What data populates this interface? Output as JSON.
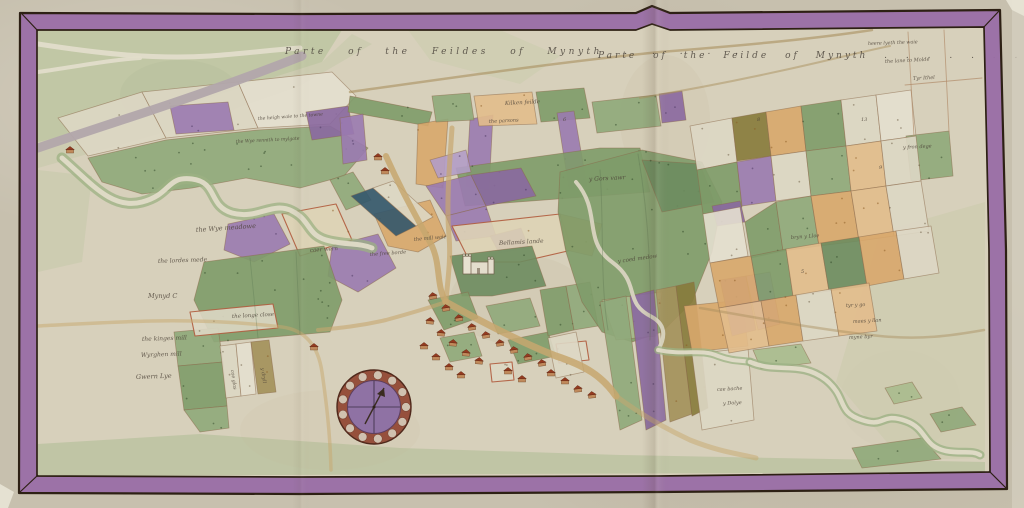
{
  "title": {
    "left": "Parte of the Feildes of Mynyth . . . . .",
    "right": "Parte of the Feilde of Mynyth . . . . . . ."
  },
  "palette": {
    "outer_parchment": "#c7c0ae",
    "map_bg": "#d7d0bb",
    "border_purple": "#9a6ea6",
    "border_outline": "#2d2014",
    "g1": "#7e9b69",
    "g2": "#8fa97a",
    "g3": "#a9bb8e",
    "g4": "#6d8c5f",
    "o1": "#d8a76c",
    "o2": "#e2bd8c",
    "o3": "#c98f52",
    "p1": "#9a7ab0",
    "p2": "#8a68a0",
    "p3": "#b39cc6",
    "w1": "#ddd7c4",
    "w2": "#e4dfcf",
    "olv": "#877a3b",
    "olv2": "#a3905a",
    "blu": "#33566c",
    "cream": "#ded3b6",
    "road": "#c7a76e",
    "hedge": "#a98f5e",
    "river_bank": "#9cb183",
    "river_water": "#e0dbc8",
    "grey_way": "#b2a7ab",
    "house_wall": "#c08a5c",
    "house_roof": "#943b20",
    "compass_ring": "#96503c",
    "compass_face": "#8f72a4",
    "default_stroke": "#8a6a4a",
    "red_stroke": "#b05b3d",
    "label_ink": "#4a4036"
  },
  "border": {
    "outer": "20,13 300,14 636,13 652,6 670,13 1000,10 1006,250 1007,489 660,492 300,494 19,493",
    "inner": "37,30 636,30 652,24 670,30 984,27 989,250 990,472 660,476 300,477 37,476"
  },
  "washes": [
    {
      "pts": "38,30 342,30 322,62 202,100 122,122 38,142",
      "fill": "#aebf93",
      "op": 0.55
    },
    {
      "pts": "38,142 122,122 202,100 322,62 352,34 372,44 300,86 180,128 38,168",
      "fill": "#b7c49c",
      "op": 0.3
    },
    {
      "pts": "880,232 985,202 985,458 902,460 836,382",
      "fill": "#c5c9a5",
      "op": 0.4
    },
    {
      "pts": "38,444 200,434 400,448 620,455 985,462 985,472 38,476",
      "fill": "#a9ba90",
      "op": 0.5
    },
    {
      "pts": "38,170 92,176 82,262 38,272",
      "fill": "#b7c49c",
      "op": 0.3
    },
    {
      "pts": "408,30 500,30 560,56 520,84 430,60",
      "fill": "#c2cba6",
      "op": 0.35
    }
  ],
  "stains": [
    {
      "cx": 520,
      "cy": 300,
      "rx": 70,
      "ry": 45,
      "fill": "#b5a584",
      "op": 0.1
    },
    {
      "cx": 665,
      "cy": 120,
      "rx": 45,
      "ry": 65,
      "fill": "#b5a584",
      "op": 0.08
    },
    {
      "cx": 180,
      "cy": 95,
      "rx": 60,
      "ry": 35,
      "fill": "#9fae84",
      "op": 0.12
    },
    {
      "cx": 330,
      "cy": 430,
      "rx": 90,
      "ry": 40,
      "fill": "#c3b694",
      "op": 0.1
    },
    {
      "cx": 900,
      "cy": 400,
      "rx": 60,
      "ry": 50,
      "fill": "#cfc8ae",
      "op": 0.12
    }
  ],
  "parcels": [
    {
      "pts": "58,118 142,92 166,138 88,156",
      "fill": "w1"
    },
    {
      "pts": "142,92 238,82 258,128 166,138",
      "fill": "w1"
    },
    {
      "pts": "238,82 332,72 356,96 330,124 258,128",
      "fill": "w2"
    },
    {
      "pts": "88,158 166,140 258,130 330,126 368,148 344,176 300,188 246,178 192,188 142,194 102,182",
      "fill": "g2"
    },
    {
      "pts": "170,106 228,102 234,130 176,134",
      "fill": "p1"
    },
    {
      "pts": "306,112 348,106 354,134 312,140",
      "fill": "p2"
    },
    {
      "pts": "228,224 274,214 290,244 254,262 224,250",
      "fill": "p1"
    },
    {
      "pts": "282,214 336,204 352,240 300,256",
      "fill": "cream",
      "stroke": "red"
    },
    {
      "pts": "332,246 378,234 396,268 358,292 328,276",
      "fill": "p1"
    },
    {
      "pts": "374,214 430,200 446,236 418,252 388,246",
      "fill": "o1"
    },
    {
      "pts": "204,262 324,246 342,300 330,332 214,342 194,300",
      "fill": "g1"
    },
    {
      "pts": "174,332 218,328 223,362 178,366",
      "fill": "g2"
    },
    {
      "pts": "178,366 223,362 227,406 184,410",
      "fill": "g1"
    },
    {
      "pts": "184,410 227,406 229,428 200,432",
      "fill": "g2"
    },
    {
      "pts": "190,312 273,304 278,328 195,336",
      "fill": "w1",
      "stroke": "red"
    },
    {
      "pts": "220,346 236,344 241,396 226,398",
      "fill": "w1"
    },
    {
      "pts": "236,344 251,342 256,394 241,396",
      "fill": "w2"
    },
    {
      "pts": "251,342 269,340 276,392 258,394",
      "fill": "olv2"
    },
    {
      "pts": "350,96 432,112 428,126 348,112",
      "fill": "g1"
    },
    {
      "pts": "340,118 363,114 367,160 343,164",
      "fill": "p1"
    },
    {
      "pts": "418,124 448,119 443,188 416,184",
      "fill": "o1"
    },
    {
      "pts": "470,119 493,115 489,190 466,187",
      "fill": "p1"
    },
    {
      "pts": "432,96 470,93 474,120 436,122",
      "fill": "g2"
    },
    {
      "pts": "474,96 532,92 537,124 479,126",
      "fill": "o2"
    },
    {
      "pts": "536,92 584,88 590,118 541,122",
      "fill": "g1"
    },
    {
      "pts": "557,113 574,111 587,186 569,189",
      "fill": "p1"
    },
    {
      "pts": "592,102 656,95 661,126 597,133",
      "fill": "g2"
    },
    {
      "pts": "659,94 682,91 686,120 662,123",
      "fill": "p2"
    },
    {
      "pts": "456,168 600,148 640,148 650,192 465,206",
      "fill": "g1"
    },
    {
      "pts": "330,180 353,172 371,200 346,210",
      "fill": "g2"
    },
    {
      "pts": "351,196 373,188 416,226 396,236",
      "fill": "blu"
    },
    {
      "pts": "373,188 393,181 433,217 416,226",
      "fill": "w1"
    },
    {
      "pts": "426,186 471,175 486,206 446,216",
      "fill": "p1"
    },
    {
      "pts": "471,175 521,168 536,196 486,206",
      "fill": "p2"
    },
    {
      "pts": "446,216 486,206 496,236 456,241",
      "fill": "p1"
    },
    {
      "pts": "490,236 521,228 529,248 499,253",
      "fill": "p2"
    },
    {
      "pts": "430,160 466,150 471,172 438,178",
      "fill": "p3"
    },
    {
      "pts": "452,226 560,214 572,250 520,262 470,262",
      "fill": "cream",
      "stroke": "red"
    },
    {
      "pts": "560,214 602,224 592,256 566,250",
      "fill": "o1"
    },
    {
      "pts": "450,256 532,246 546,286 492,296 462,296",
      "fill": "g4"
    },
    {
      "pts": "428,300 468,292 478,318 444,330",
      "fill": "g1"
    },
    {
      "pts": "486,306 530,298 540,326 498,334",
      "fill": "g2"
    },
    {
      "pts": "508,340 548,332 556,356 518,364",
      "fill": "g1"
    },
    {
      "pts": "440,338 474,332 482,356 450,362",
      "fill": "g2"
    },
    {
      "pts": "490,364 512,362 514,380 492,382",
      "fill": "w1",
      "stroke": "red"
    },
    {
      "pts": "556,344 586,341 589,360 559,363",
      "fill": "w1",
      "stroke": "red"
    },
    {
      "pts": "540,290 566,286 574,330 548,336",
      "fill": "g1"
    },
    {
      "pts": "566,286 590,282 598,326 574,330",
      "fill": "g2"
    },
    {
      "pts": "548,338 576,332 584,372 556,378",
      "fill": "w1"
    },
    {
      "pts": "560,172 642,150 702,162 722,202 712,252 692,302 662,332 632,342 602,332 582,302 566,252 558,212",
      "fill": "g1"
    },
    {
      "pts": "642,160 700,164 714,202 662,212",
      "fill": "g4"
    },
    {
      "pts": "602,300 662,292 656,336 616,340",
      "fill": "g3"
    },
    {
      "pts": "600,302 626,296 642,420 620,430",
      "fill": "g2"
    },
    {
      "pts": "630,296 654,290 666,420 646,430",
      "fill": "p2"
    },
    {
      "pts": "656,290 676,286 692,414 670,422",
      "fill": "olv2"
    },
    {
      "pts": "676,286 694,282 708,408 692,416",
      "fill": "olv"
    },
    {
      "pts": "684,306 742,300 748,346 692,352",
      "fill": "o1"
    },
    {
      "pts": "692,354 748,348 754,420 702,430",
      "fill": "w1"
    },
    {
      "pts": "720,280 746,276 756,330 732,336",
      "fill": "p1"
    },
    {
      "pts": "746,276 770,272 780,324 758,330",
      "fill": "p3"
    },
    {
      "pts": "690,126 732,118 737,162 697,170",
      "fill": "w1"
    },
    {
      "pts": "732,118 766,112 771,156 737,161",
      "fill": "olv"
    },
    {
      "pts": "766,112 801,106 806,151 771,156",
      "fill": "o1"
    },
    {
      "pts": "801,106 841,100 846,146 806,151",
      "fill": "g1"
    },
    {
      "pts": "841,100 876,95 881,141 846,146",
      "fill": "w1"
    },
    {
      "pts": "876,95 911,90 916,136 881,141",
      "fill": "w2"
    },
    {
      "pts": "906,136 949,131 953,176 911,181",
      "fill": "g2"
    },
    {
      "pts": "697,170 737,162 742,207 703,214",
      "fill": "g1"
    },
    {
      "pts": "737,162 771,156 776,201 742,206",
      "fill": "p1"
    },
    {
      "pts": "771,156 806,151 811,196 776,201",
      "fill": "w1"
    },
    {
      "pts": "806,151 846,146 851,191 811,196",
      "fill": "g2"
    },
    {
      "pts": "846,146 881,141 886,186 851,191",
      "fill": "o2"
    },
    {
      "pts": "881,141 916,136 921,181 886,186",
      "fill": "w1"
    },
    {
      "pts": "712,206 740,201 745,222 717,226",
      "fill": "p2"
    },
    {
      "pts": "703,214 740,207 748,256 710,263",
      "fill": "w2"
    },
    {
      "pts": "745,222 776,202 783,251 751,258",
      "fill": "g1"
    },
    {
      "pts": "776,202 811,196 819,246 783,251",
      "fill": "g2"
    },
    {
      "pts": "811,196 851,191 859,241 819,246",
      "fill": "o1"
    },
    {
      "pts": "851,191 886,186 894,236 859,241",
      "fill": "o2"
    },
    {
      "pts": "886,186 921,181 929,231 894,236",
      "fill": "w1"
    },
    {
      "pts": "710,263 751,256 759,301 719,308",
      "fill": "o1"
    },
    {
      "pts": "751,256 786,249 793,296 759,301",
      "fill": "g1"
    },
    {
      "pts": "786,249 821,243 829,291 793,296",
      "fill": "o2"
    },
    {
      "pts": "821,243 859,237 867,286 829,291",
      "fill": "g4"
    },
    {
      "pts": "859,237 896,231 904,279 867,286",
      "fill": "o1"
    },
    {
      "pts": "896,231 931,226 939,273 904,279",
      "fill": "w1"
    },
    {
      "pts": "719,308 761,301 769,346 729,353",
      "fill": "o2"
    },
    {
      "pts": "761,301 796,295 803,341 769,346",
      "fill": "o1"
    },
    {
      "pts": "796,295 831,289 839,336 803,341",
      "fill": "w1"
    },
    {
      "pts": "831,289 869,283 877,331 839,336",
      "fill": "o2"
    },
    {
      "pts": "753,350 801,344 811,363 761,369",
      "fill": "g3"
    },
    {
      "pts": "852,448 922,438 941,459 862,468",
      "fill": "g2"
    },
    {
      "pts": "930,414 962,407 976,425 941,432",
      "fill": "g2"
    },
    {
      "pts": "885,388 912,382 922,398 894,404",
      "fill": "g3"
    }
  ],
  "rivers": [
    {
      "d": "M38,148 C120,120 200,96 302,56",
      "bw": 0,
      "bc": "none",
      "ww": 9,
      "wc": "#b2a7ab"
    },
    {
      "d": "M38,44 C90,52 150,60 210,56 C250,53 270,50 300,48",
      "bw": 0,
      "bc": "none",
      "ww": 5,
      "wc": "#e2ddca"
    },
    {
      "d": "M38,72 C80,66 110,60 140,58",
      "bw": 0,
      "bc": "none",
      "ww": 4,
      "wc": "#e2ddca"
    },
    {
      "d": "M62,158 C92,184 112,210 142,202 C172,194 166,176 192,179 C218,182 208,206 232,213 C258,220 272,201 292,211 C312,221 306,236 330,241 C348,245 360,243 372,248",
      "bw": 11,
      "bc": "#9cb183",
      "ww": 5,
      "wc": "#e0dbc8"
    },
    {
      "d": "M576,182 C602,212 582,240 612,262 C642,284 622,302 652,317 C668,326 664,340 658,350",
      "bw": 0,
      "bc": "none",
      "ww": 4,
      "wc": "#d9d4c0"
    },
    {
      "d": "M658,350 C686,356 700,348 718,356 C734,362 742,360 750,362",
      "bw": 8,
      "bc": "#9cb183",
      "ww": 4,
      "wc": "#e0dbc8"
    },
    {
      "d": "M750,362 C778,374 800,360 826,380 C848,398 836,412 862,420 C886,428 880,412 906,421 C928,429 922,446 946,451 C962,454 972,450 980,455",
      "bw": 9,
      "bc": "#9bb083",
      "ww": 4.5,
      "wc": "#e0dbc8"
    }
  ],
  "roads": [
    {
      "d": "M386,156 C402,192 416,216 432,246 C441,266 436,286 446,302",
      "w": 6,
      "c": "#c7a76e",
      "o": 0.85
    },
    {
      "d": "M446,302 C482,322 520,342 556,356 C586,366 602,376 616,396",
      "w": 7,
      "c": "#c7a76e",
      "o": 0.85
    },
    {
      "d": "M452,128 C450,160 446,200 449,236 C451,258 448,278 446,300",
      "w": 5,
      "c": "#c7a76e",
      "o": 0.7
    },
    {
      "d": "M616,396 C640,414 664,428 690,440 C720,452 740,454 756,458",
      "w": 5,
      "c": "#c7a76e",
      "o": 0.5
    },
    {
      "d": "M446,302 C428,308 408,314 386,320 C360,326 340,328 318,330",
      "w": 4,
      "c": "#c7a76e",
      "o": 0.6
    },
    {
      "d": "M38,326 C120,322 190,316 282,327 C305,330 318,345 322,372 C326,400 330,430 331,470",
      "w": 3.5,
      "c": "#c7a76e",
      "o": 0.5
    },
    {
      "d": "M350,92 C450,78 560,62 660,52 C760,44 820,38 872,30",
      "w": 2.5,
      "c": "#a98f5e",
      "o": 0.6
    },
    {
      "d": "M640,98 C700,88 760,76 820,62 C850,55 870,50 890,46",
      "w": 2,
      "c": "#a98f5e",
      "o": 0.5
    },
    {
      "d": "M700,308 C760,318 820,330 880,336 C920,340 950,336 984,330",
      "w": 2.5,
      "c": "#a98f5e",
      "o": 0.45
    },
    {
      "d": "M908,32 L914,136",
      "w": 0.9,
      "c": "#b08a68",
      "o": 0.7
    },
    {
      "d": "M944,30 L949,132",
      "w": 0.9,
      "c": "#b08a68",
      "o": 0.7
    },
    {
      "d": "M905,85 L982,78",
      "w": 0.9,
      "c": "#b08a68",
      "o": 0.7
    },
    {
      "d": "M600,170 C604,224 600,282 608,330",
      "w": 1,
      "c": "#5c7350",
      "o": 0.35
    },
    {
      "d": "M638,154 C648,212 652,272 650,340",
      "w": 1,
      "c": "#5c7350",
      "o": 0.35
    },
    {
      "d": "M250,258 L258,338",
      "w": 0.9,
      "c": "#54704c",
      "o": 0.3
    },
    {
      "d": "M296,252 L300,334",
      "w": 0.9,
      "c": "#54704c",
      "o": 0.3
    }
  ],
  "houses": [
    [
      433,
      297,
      -8
    ],
    [
      446,
      309,
      -8
    ],
    [
      459,
      319,
      -8
    ],
    [
      472,
      328,
      -8
    ],
    [
      486,
      336,
      -8
    ],
    [
      500,
      344,
      -8
    ],
    [
      514,
      351,
      -8
    ],
    [
      528,
      358,
      -8
    ],
    [
      542,
      364,
      -8
    ],
    [
      430,
      322,
      5
    ],
    [
      441,
      334,
      5
    ],
    [
      453,
      344,
      5
    ],
    [
      466,
      354,
      5
    ],
    [
      479,
      362,
      5
    ],
    [
      424,
      347,
      0
    ],
    [
      436,
      358,
      0
    ],
    [
      449,
      368,
      0
    ],
    [
      461,
      376,
      0
    ],
    [
      508,
      372,
      0
    ],
    [
      522,
      380,
      0
    ],
    [
      551,
      374,
      0
    ],
    [
      565,
      382,
      0
    ],
    [
      578,
      390,
      -6
    ],
    [
      592,
      396,
      -6
    ],
    [
      378,
      158,
      0
    ],
    [
      385,
      172,
      0
    ],
    [
      70,
      151,
      0
    ],
    [
      314,
      348,
      0
    ]
  ],
  "church": {
    "x": 468,
    "y": 252
  },
  "compass": {
    "cx": 374,
    "cy": 407,
    "r": 37
  },
  "labels": [
    {
      "x": 196,
      "y": 232,
      "text": "the Wye meadowe",
      "s": 6.5,
      "r": -4
    },
    {
      "x": 158,
      "y": 263,
      "text": "the lordes mede",
      "s": 6,
      "r": -2
    },
    {
      "x": 148,
      "y": 298,
      "text": "Mynyd C",
      "s": 6.5,
      "r": 0
    },
    {
      "x": 232,
      "y": 318,
      "text": "the longe close",
      "s": 5.5,
      "r": -3
    },
    {
      "x": 142,
      "y": 341,
      "text": "the kinges mill",
      "s": 6,
      "r": -2
    },
    {
      "x": 141,
      "y": 357,
      "text": "Wyrghen mill",
      "s": 6,
      "r": -2
    },
    {
      "x": 136,
      "y": 379,
      "text": "Gwern Lye",
      "s": 6.5,
      "r": -2
    },
    {
      "x": 231,
      "y": 370,
      "text": "cae glas",
      "s": 4.8,
      "r": 82
    },
    {
      "x": 261,
      "y": 368,
      "text": "y dryll",
      "s": 4.8,
      "r": 82
    },
    {
      "x": 310,
      "y": 252,
      "text": "caer wern",
      "s": 5.5,
      "r": -4
    },
    {
      "x": 370,
      "y": 256,
      "text": "the free borde",
      "s": 5,
      "r": -4
    },
    {
      "x": 414,
      "y": 241,
      "text": "the mill waie",
      "s": 5,
      "r": -5
    },
    {
      "x": 499,
      "y": 245,
      "text": "Bellamis lande",
      "s": 6,
      "r": -3
    },
    {
      "x": 489,
      "y": 123,
      "text": "the parsons",
      "s": 5,
      "r": -3
    },
    {
      "x": 505,
      "y": 105,
      "text": "Kilken feilde",
      "s": 5.5,
      "r": -3
    },
    {
      "x": 589,
      "y": 181,
      "text": "y Gors vawr",
      "s": 6,
      "r": -3
    },
    {
      "x": 618,
      "y": 263,
      "text": "y coed medow",
      "s": 5.5,
      "r": -8
    },
    {
      "x": 717,
      "y": 391,
      "text": "cae bache",
      "s": 5,
      "r": -3
    },
    {
      "x": 723,
      "y": 405,
      "text": "y Dolye",
      "s": 5,
      "r": -3
    },
    {
      "x": 791,
      "y": 239,
      "text": "bryn y Lloe",
      "s": 5,
      "r": -4
    },
    {
      "x": 846,
      "y": 307,
      "text": "tyr y go",
      "s": 5,
      "r": -3
    },
    {
      "x": 853,
      "y": 323,
      "text": "maes y llan",
      "s": 5,
      "r": -3
    },
    {
      "x": 849,
      "y": 339,
      "text": "myne byr",
      "s": 5,
      "r": -3
    },
    {
      "x": 885,
      "y": 63,
      "text": "the lane to Molde",
      "s": 5,
      "r": -3
    },
    {
      "x": 913,
      "y": 80,
      "text": "Tyr Ithel",
      "s": 5,
      "r": -3
    },
    {
      "x": 903,
      "y": 149,
      "text": "y fron dege",
      "s": 5,
      "r": -3
    },
    {
      "x": 868,
      "y": 45,
      "text": "heere lyeth the waie",
      "s": 4.8,
      "r": -2
    },
    {
      "x": 258,
      "y": 120,
      "text": "the heigh waie to the towne",
      "s": 4.6,
      "r": -4
    },
    {
      "x": 236,
      "y": 143,
      "text": "the Wye rennith to mylgate",
      "s": 4.6,
      "r": -3
    },
    {
      "x": 861,
      "y": 121,
      "text": "13",
      "s": 5,
      "r": 0
    },
    {
      "x": 879,
      "y": 169,
      "text": "9",
      "s": 5,
      "r": 0
    },
    {
      "x": 801,
      "y": 273,
      "text": "5",
      "s": 5,
      "r": 0
    },
    {
      "x": 757,
      "y": 121,
      "text": "8",
      "s": 5,
      "r": 0
    },
    {
      "x": 563,
      "y": 121,
      "text": "6",
      "s": 5,
      "r": 0
    }
  ],
  "folds": [
    {
      "x": 642,
      "w": 28,
      "op": 0.3
    },
    {
      "x": 292,
      "w": 18,
      "op": 0.12
    }
  ],
  "corners": [
    {
      "pts": "0,484 14,492 8,508 0,508",
      "fill": "#e8e4d6",
      "op": 0.9
    },
    {
      "pts": "1006,0 1024,0 1024,16 1012,10",
      "fill": "#e8e4d6",
      "op": 0.9
    }
  ]
}
